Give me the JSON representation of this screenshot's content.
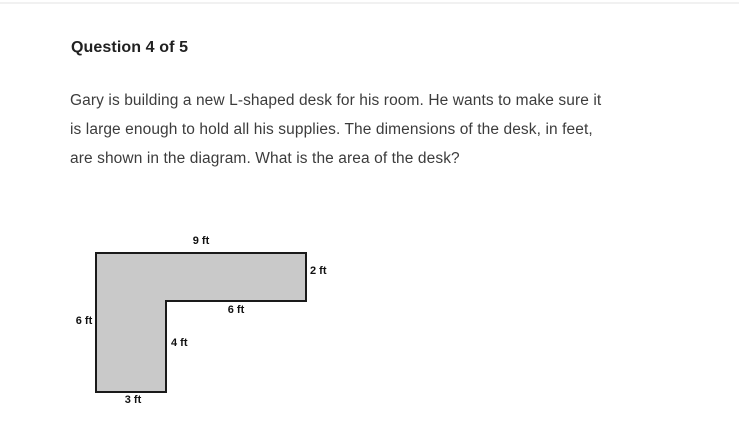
{
  "page": {
    "header": "Question 4 of 5",
    "question_lines": [
      "Gary is building a new L-shaped desk for his room. He wants to make sure it",
      "is large enough to hold all his supplies. The dimensions of the desk, in feet,",
      "are shown in the diagram. What is the area of the desk?"
    ]
  },
  "diagram": {
    "description": "L-shaped desk top view polygon",
    "unit": "ft",
    "fill_color": "#c9c9c9",
    "stroke_color": "#1a1a1a",
    "labels": {
      "top": "9 ft",
      "right": "2 ft",
      "inner_horizontal": "6 ft",
      "left": "6 ft",
      "inner_vertical": "4 ft",
      "bottom": "3 ft"
    },
    "dimensions_ft": {
      "top": 9,
      "right": 2,
      "inner_horizontal": 6,
      "left": 6,
      "inner_vertical": 4,
      "bottom": 3
    }
  }
}
